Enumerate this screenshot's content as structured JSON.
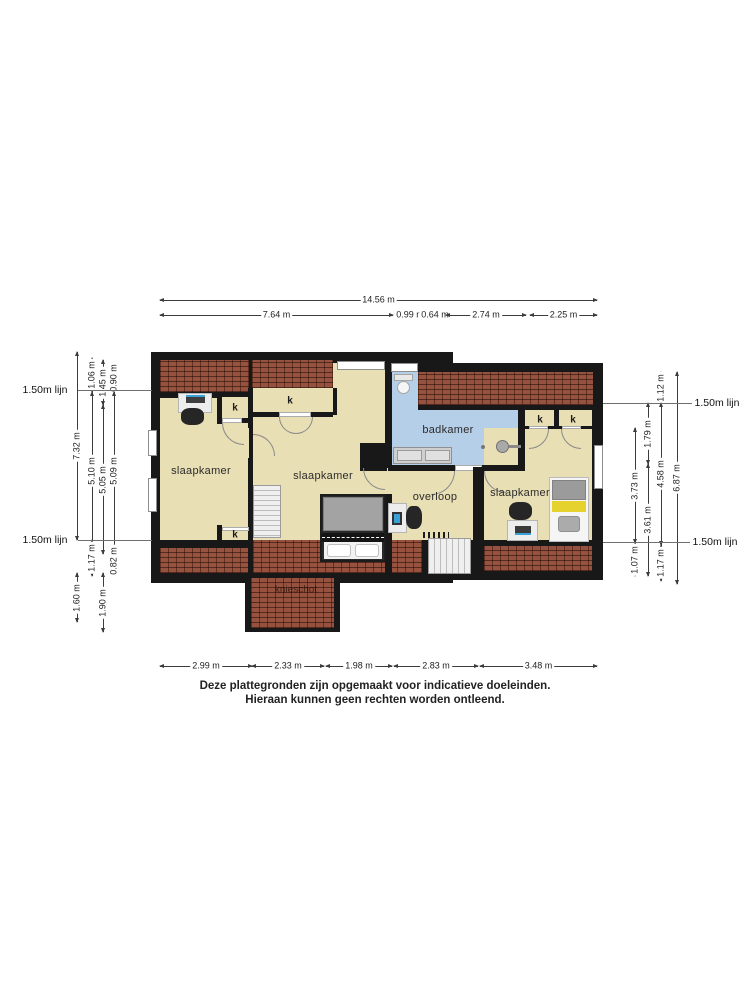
{
  "rooms": {
    "bedroom_left": "slaapkamer",
    "bedroom_middle": "slaapkamer",
    "bedroom_right": "slaapkamer",
    "bathroom": "badkamer",
    "landing": "overloop",
    "kneewall": "knieschot"
  },
  "closet_label": "k",
  "closet_positions": [
    {
      "x": 235,
      "y": 408
    },
    {
      "x": 290,
      "y": 401
    },
    {
      "x": 540,
      "y": 420
    },
    {
      "x": 573,
      "y": 420
    },
    {
      "x": 235,
      "y": 535
    }
  ],
  "lijn_label": "1.50m lijn",
  "lijn_lines": [
    {
      "x1": 78,
      "x2": 152,
      "y": 390,
      "lx": 45
    },
    {
      "x1": 78,
      "x2": 152,
      "y": 540,
      "lx": 45
    },
    {
      "x1": 603,
      "x2": 692,
      "y": 403,
      "lx": 717
    },
    {
      "x1": 603,
      "x2": 690,
      "y": 542,
      "lx": 715
    }
  ],
  "dimensions": {
    "top": [
      {
        "label": "14.56 m",
        "x1": 160,
        "x2": 597,
        "y": 300
      },
      {
        "label": "7.64 m",
        "x1": 160,
        "x2": 393,
        "y": 315
      },
      {
        "label": "0.99 m",
        "x1": 396,
        "x2": 424,
        "y": 315
      },
      {
        "label": "0.64 m",
        "x1": 426,
        "x2": 444,
        "y": 315
      },
      {
        "label": "2.74 m",
        "x1": 446,
        "x2": 526,
        "y": 315
      },
      {
        "label": "2.25 m",
        "x1": 530,
        "x2": 597,
        "y": 315
      }
    ],
    "bottom": [
      {
        "label": "2.99 m",
        "x1": 160,
        "x2": 252,
        "y": 666
      },
      {
        "label": "2.33 m",
        "x1": 252,
        "x2": 324,
        "y": 666
      },
      {
        "label": "1.98 m",
        "x1": 326,
        "x2": 392,
        "y": 666
      },
      {
        "label": "2.83 m",
        "x1": 394,
        "x2": 478,
        "y": 666
      },
      {
        "label": "3.48 m",
        "x1": 480,
        "x2": 597,
        "y": 666
      }
    ],
    "left": [
      {
        "label": "7.32 m",
        "x": 77,
        "y1": 352,
        "y2": 540
      },
      {
        "label": "1.60 m",
        "x": 77,
        "y1": 573,
        "y2": 622
      },
      {
        "label": "1.06 m",
        "x": 92,
        "y1": 358,
        "y2": 392
      },
      {
        "label": "5.10 m",
        "x": 92,
        "y1": 392,
        "y2": 549
      },
      {
        "label": "1.17 m",
        "x": 92,
        "y1": 540,
        "y2": 576
      },
      {
        "label": "1.45 m",
        "x": 103,
        "y1": 360,
        "y2": 405
      },
      {
        "label": "5.05 m",
        "x": 103,
        "y1": 405,
        "y2": 554
      },
      {
        "label": "1.90 m",
        "x": 103,
        "y1": 573,
        "y2": 632
      },
      {
        "label": "0.90 m",
        "x": 114,
        "y1": 364,
        "y2": 392
      },
      {
        "label": "5.09 m",
        "x": 114,
        "y1": 392,
        "y2": 549
      },
      {
        "label": "0.82 m",
        "x": 114,
        "y1": 548,
        "y2": 574
      }
    ],
    "right": [
      {
        "label": "3.73 m",
        "x": 635,
        "y1": 428,
        "y2": 543
      },
      {
        "label": "1.07 m",
        "x": 635,
        "y1": 543,
        "y2": 576
      },
      {
        "label": "1.79 m",
        "x": 648,
        "y1": 403,
        "y2": 464
      },
      {
        "label": "3.61 m",
        "x": 648,
        "y1": 464,
        "y2": 576
      },
      {
        "label": "1.12 m",
        "x": 661,
        "y1": 372,
        "y2": 403
      },
      {
        "label": "4.58 m",
        "x": 661,
        "y1": 403,
        "y2": 545
      },
      {
        "label": "1.17 m",
        "x": 661,
        "y1": 545,
        "y2": 581
      },
      {
        "label": "6.87 m",
        "x": 677,
        "y1": 372,
        "y2": 584
      }
    ]
  },
  "disclaimer": {
    "line1": "Deze plattegronden zijn opgemaakt voor indicatieve doeleinden.",
    "line2": "Hieraan kunnen geen rechten worden ontleend."
  },
  "colors": {
    "wall": "#181818",
    "floor": "#e9dfb4",
    "bathroom": "#b6cfe9",
    "roof_hatch": "#96523f",
    "bed_accent_yellow": "#e6d22e"
  }
}
